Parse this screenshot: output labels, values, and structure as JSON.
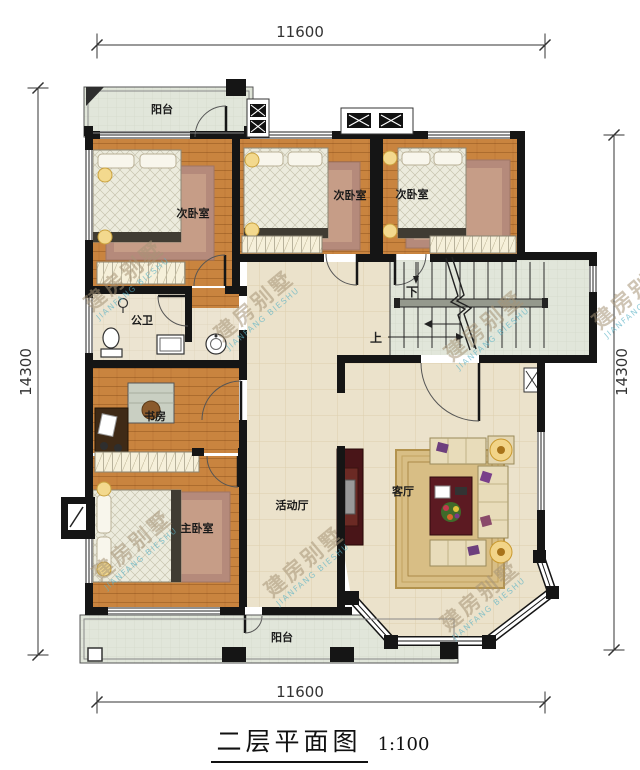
{
  "drawing": {
    "title": "二层平面图",
    "scale": "1:100"
  },
  "dimensions": {
    "top": "11600",
    "bottom": "11600",
    "left": "14300",
    "right": "14300"
  },
  "rooms": {
    "balcony_top": "阳台",
    "bedroom_left": "次卧室",
    "bedroom_middle": "次卧室",
    "bedroom_right": "次卧室",
    "bathroom": "公卫",
    "study": "书房",
    "master_bedroom": "主卧室",
    "activity_hall": "活动厅",
    "living_room": "客厅",
    "balcony_bottom": "阳台"
  },
  "stairs": {
    "down": "下",
    "up": "上"
  },
  "watermark": {
    "cn": "建房别墅",
    "en": "JIANFANG BIESHU"
  },
  "colors": {
    "wall": "#151515",
    "wood_floor": "#c9843f",
    "tile_floor": "#ebe2cb",
    "balcony_floor": "#e1e6da",
    "bath_floor": "#ece4d1",
    "rug": "#b58a7b",
    "accent_gold": "#e7b54d",
    "table_red": "#5c1a22"
  }
}
